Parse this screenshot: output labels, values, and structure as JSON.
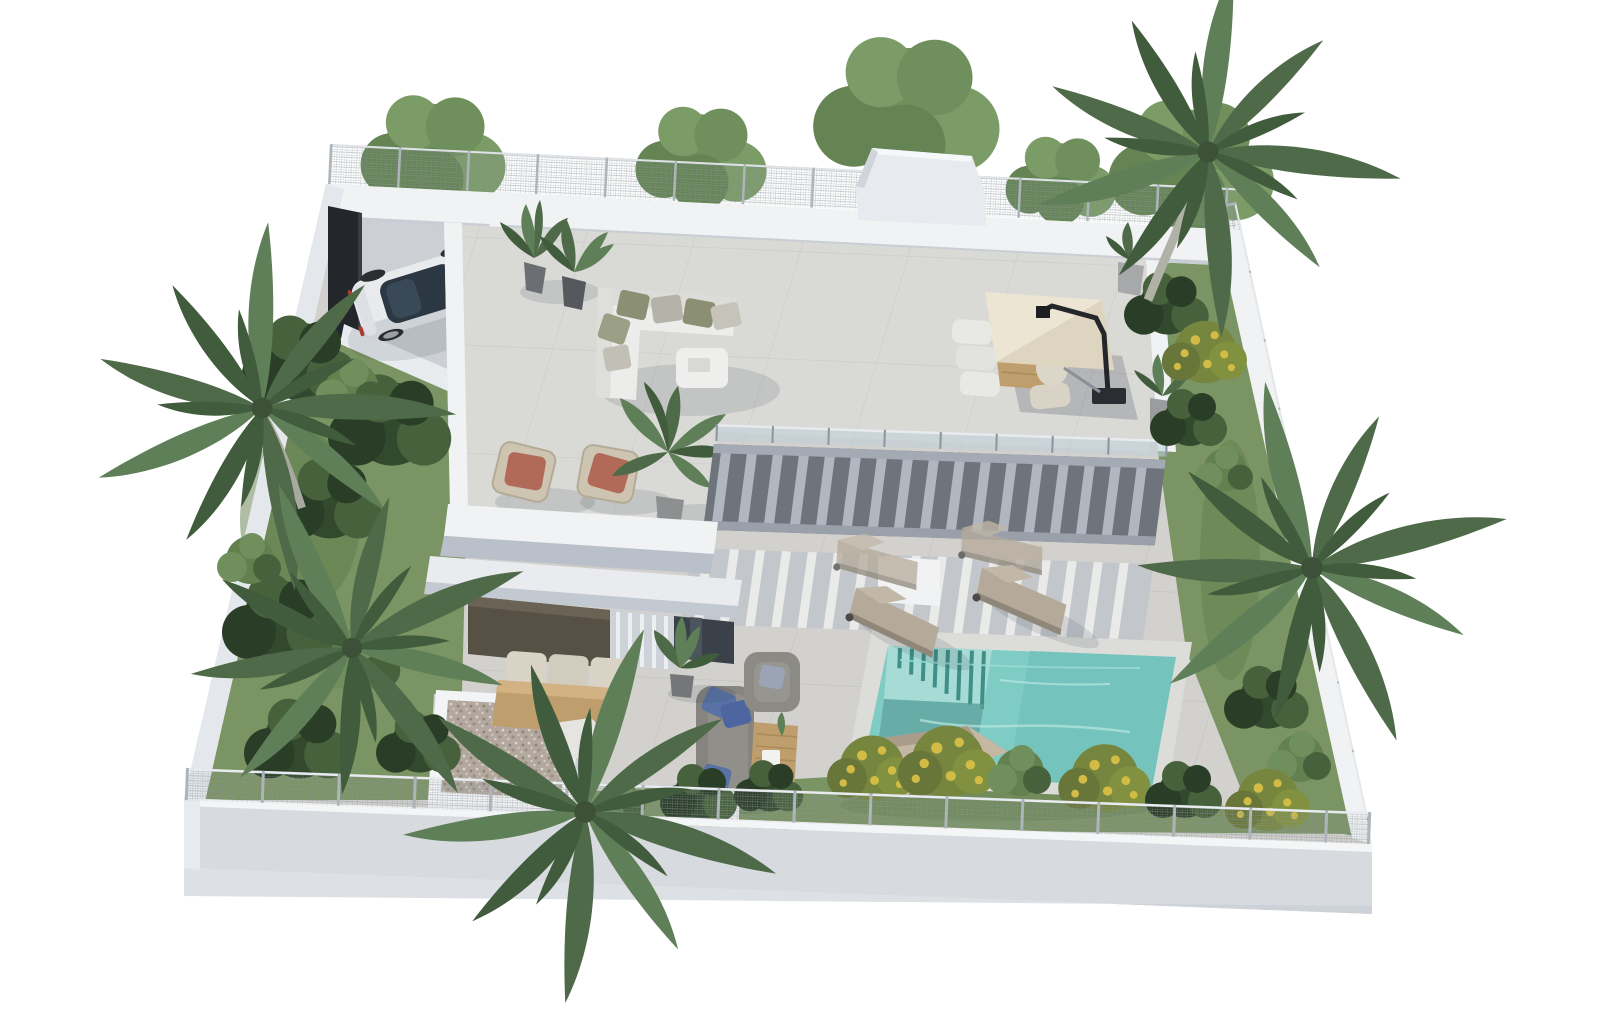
{
  "meta": {
    "type": "3d-architectural-render",
    "subject": "aerial isometric rendering of a modern two-storey villa plot with roof terrace, swimming pool, gardens and carport",
    "background": "#ffffff"
  },
  "palette": {
    "wall_white": "#f0f2f4",
    "wall_face": "#d7dbe0",
    "wall_side": "#e4e8ec",
    "terrace_tile": "#d9d9d6",
    "courtyard_tile": "#d2d1cd",
    "driveway": "#ccd0d4",
    "pool_water": "#7fccc5",
    "pool_steps": "#a6dcd5",
    "pool_deep": "#6cbfb8",
    "pool_stripe": "#3f8e88",
    "grass": "#7b9463",
    "grass_dark": "#5f7b4c",
    "tree_green": "#6f8f5c",
    "palm_green": "#4e6a48",
    "pergola_slat": "#b0b7c0",
    "pergola_void": "#6e747c",
    "glass_rail": "#bfd0da",
    "parasol_cream": "#ece5d4",
    "wood": "#bf9e6e",
    "sofa_white": "#ececea",
    "cushion_olive": "#8b8f73",
    "cushion_terracotta": "#b26a58",
    "lounge_gray": "#85847f",
    "pillow_blue": "#5872a5",
    "lounger_taupe": "#b5aa99",
    "gravel": "#b3a89d",
    "car_body": "#e9eaec",
    "car_glass": "#2c3744",
    "gate_dark": "#23262a",
    "fence_mesh": "#9aa1a8"
  },
  "objects": [
    {
      "id": "perimeter-wall",
      "label": "white perimeter wall"
    },
    {
      "id": "mesh-fence",
      "label": "security mesh fence"
    },
    {
      "id": "carport",
      "label": "carport with sedan"
    },
    {
      "id": "entrance-gate-panel",
      "label": "dark entrance gate panel"
    },
    {
      "id": "roof-terrace",
      "label": "tiled roof terrace"
    },
    {
      "id": "corner-sofa",
      "label": "white corner lounge sofa"
    },
    {
      "id": "wicker-chairs",
      "label": "wicker chairs with terracotta cushions"
    },
    {
      "id": "roof-dining-set",
      "label": "outdoor dining table with cantilever parasol"
    },
    {
      "id": "glass-balustrade",
      "label": "glass balustrade"
    },
    {
      "id": "pergola",
      "label": "slatted pergola"
    },
    {
      "id": "sun-loungers",
      "label": "sun loungers"
    },
    {
      "id": "swimming-pool",
      "label": "turquoise swimming pool with steps"
    },
    {
      "id": "garden",
      "label": "lawn and shrub gardens"
    },
    {
      "id": "palm-trees",
      "label": "palm trees"
    },
    {
      "id": "gravel-roof",
      "label": "gravel-topped annex roof"
    },
    {
      "id": "patio-dining",
      "label": "patio dining table"
    },
    {
      "id": "patio-lounge",
      "label": "gray patio sofa set with blue pillows"
    },
    {
      "id": "ground-floor",
      "label": "ground floor with dark cladding and glazing"
    }
  ]
}
